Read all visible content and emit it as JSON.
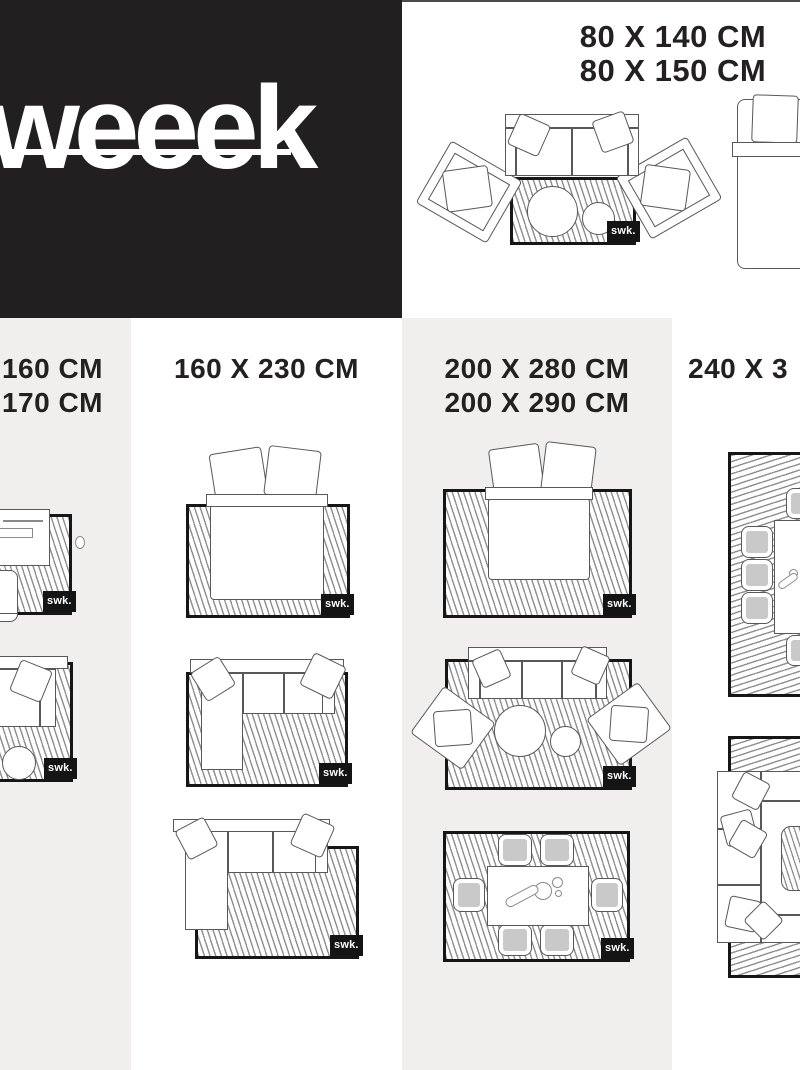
{
  "brand": {
    "logo_text": "weeek",
    "rug_tag": "swk."
  },
  "colors": {
    "logo_block": "#211f1f",
    "panel_gray": "#f0efed",
    "heading_text": "#242021",
    "rug_border": "#161616",
    "hatch_line": "#8f8f8f",
    "chair_seat": "#c9c9c9"
  },
  "headings": {
    "top": {
      "line1": "80 X 140 CM",
      "line2": "80 X 150 CM"
    },
    "col1": {
      "line1": "160 CM",
      "line2": "170 CM"
    },
    "col2": {
      "line1": "160 X 230 CM"
    },
    "col3": {
      "line1": "200 X 280 CM",
      "line2": "200 X 290 CM"
    },
    "col4": {
      "line1": "240 X 3"
    }
  }
}
